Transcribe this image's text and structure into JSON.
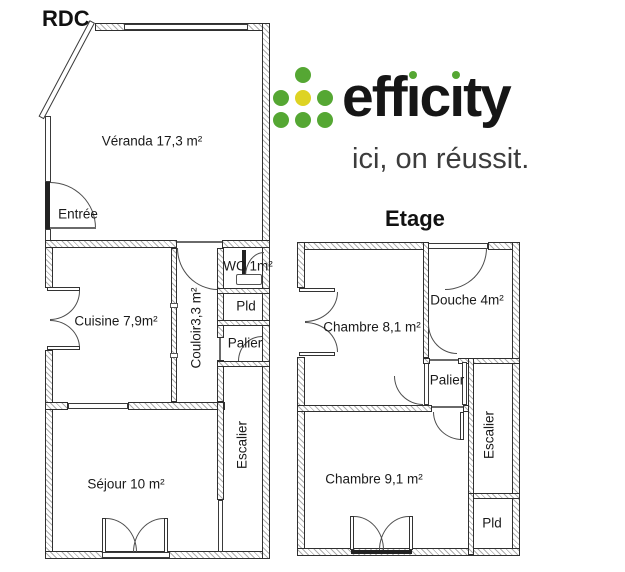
{
  "logo": {
    "brand": "efficity",
    "brand_parts": {
      "eff": "eff",
      "i": "ı",
      "c": "c",
      "ty": "ty"
    },
    "tagline": "ici, on réussit.",
    "colors": {
      "dot_green": "#55a733",
      "dot_yellow": "#ded323",
      "brand_text": "#161616",
      "tagline_text": "#3c3c3c"
    }
  },
  "rdc": {
    "title": "RDC",
    "veranda": "Véranda 17,3 m²",
    "entree": "Entrée",
    "cuisine": "Cuisine 7,9m²",
    "couloir": "Couloir3,3 m²",
    "wc": "WC 1m²",
    "pld": "Pld",
    "palier": "Palier",
    "escalier": "Escalier",
    "sejour": "Séjour 10 m²"
  },
  "etage": {
    "title": "Etage",
    "chambre1": "Chambre 8,1 m²",
    "douche": "Douche 4m²",
    "palier": "Palier",
    "chambre2": "Chambre 9,1 m²",
    "escalier": "Escalier",
    "pld": "Pld"
  }
}
